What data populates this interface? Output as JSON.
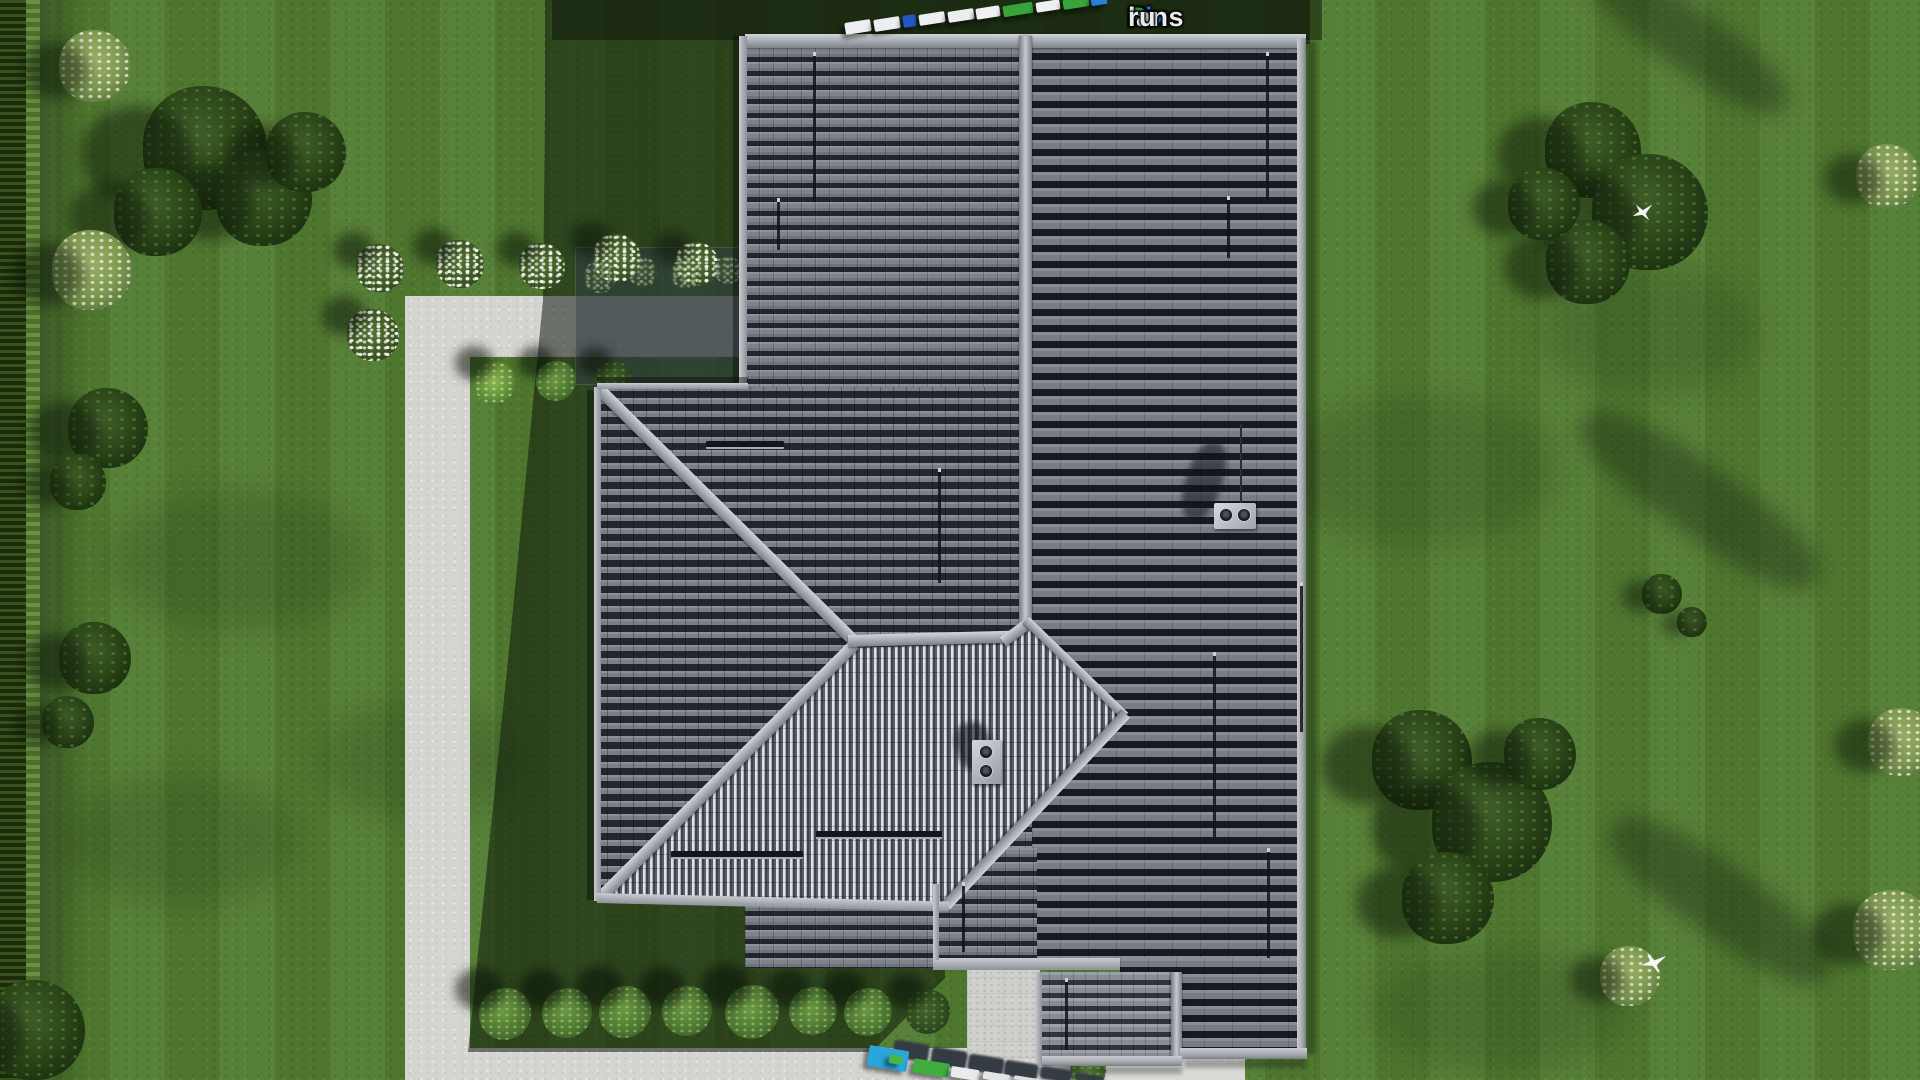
{
  "watermark": {
    "parts": [
      {
        "text": "Fix",
        "color": "#2e6ad4"
      },
      {
        "text": "P",
        "color": "#2f9e3c"
      },
      {
        "text": "lans",
        "color": "#e9ebee"
      },
      {
        "text": ".",
        "color": "#a81e1e"
      },
      {
        "text": "ru",
        "color": "#e9ebee"
      }
    ]
  },
  "palette": {
    "roof_dark": "#555a62",
    "roof_east_slope": "#7d828a",
    "roof_striped_light": "#dfe1e4",
    "roof_striped_dark": "#3e424a",
    "ridge_cap": "#c9ccd1",
    "fascia": "#b8bcc1",
    "walkway": "#d4d4d1",
    "patio": "#cfcfcb",
    "concrete_pad": "#dadad7",
    "grass": "#517b31",
    "grass_shadow": "#26401a",
    "hedge": "#24390f",
    "tree_dark": "#2c4719",
    "tree_light": "#8aa45c",
    "bush_green": "#55823a",
    "car_blue": "#2257c4",
    "car_cyan": "#2aa6db",
    "car_green": "#3fae3f",
    "car_white": "#eceef0"
  },
  "scene": {
    "grass_patches": [
      {
        "x": 240,
        "y": 560,
        "w": 260,
        "h": 140
      },
      {
        "x": 180,
        "y": 840,
        "w": 230,
        "h": 130
      },
      {
        "x": 420,
        "y": 760,
        "w": 200,
        "h": 120
      },
      {
        "x": 1420,
        "y": 470,
        "w": 280,
        "h": 150
      },
      {
        "x": 1650,
        "y": 330,
        "w": 220,
        "h": 130
      },
      {
        "x": 1500,
        "y": 1010,
        "w": 260,
        "h": 120
      }
    ],
    "shadow_streaks": [
      {
        "x": 1690,
        "y": 40,
        "w": 230,
        "h": 60,
        "rot": 35
      },
      {
        "x": 1700,
        "y": 500,
        "w": 280,
        "h": 70,
        "rot": 35
      },
      {
        "x": 1720,
        "y": 900,
        "w": 260,
        "h": 70,
        "rot": 35
      }
    ],
    "trees": [
      {
        "x": 205,
        "y": 148,
        "r": 62,
        "type": "dark"
      },
      {
        "x": 264,
        "y": 198,
        "r": 48,
        "type": "dark"
      },
      {
        "x": 158,
        "y": 212,
        "r": 44,
        "type": "dark"
      },
      {
        "x": 306,
        "y": 152,
        "r": 40,
        "type": "dark"
      },
      {
        "x": 95,
        "y": 66,
        "r": 36,
        "type": "light"
      },
      {
        "x": 92,
        "y": 270,
        "r": 40,
        "type": "light"
      },
      {
        "x": 108,
        "y": 428,
        "r": 40,
        "type": "dark"
      },
      {
        "x": 78,
        "y": 482,
        "r": 28,
        "type": "dark"
      },
      {
        "x": 95,
        "y": 658,
        "r": 36,
        "type": "dark"
      },
      {
        "x": 68,
        "y": 722,
        "r": 26,
        "type": "dark"
      },
      {
        "x": 35,
        "y": 1030,
        "r": 50,
        "type": "dark"
      },
      {
        "x": 1593,
        "y": 150,
        "r": 48,
        "type": "dark"
      },
      {
        "x": 1650,
        "y": 212,
        "r": 58,
        "type": "dark"
      },
      {
        "x": 1588,
        "y": 262,
        "r": 42,
        "type": "dark"
      },
      {
        "x": 1544,
        "y": 204,
        "r": 36,
        "type": "dark"
      },
      {
        "x": 1888,
        "y": 176,
        "r": 32,
        "type": "light"
      },
      {
        "x": 1902,
        "y": 742,
        "r": 34,
        "type": "light"
      },
      {
        "x": 1893,
        "y": 930,
        "r": 40,
        "type": "light"
      },
      {
        "x": 1422,
        "y": 760,
        "r": 50,
        "type": "dark"
      },
      {
        "x": 1492,
        "y": 822,
        "r": 60,
        "type": "dark"
      },
      {
        "x": 1448,
        "y": 898,
        "r": 46,
        "type": "dark"
      },
      {
        "x": 1540,
        "y": 754,
        "r": 36,
        "type": "dark"
      },
      {
        "x": 1630,
        "y": 976,
        "r": 30,
        "type": "light"
      },
      {
        "x": 1662,
        "y": 594,
        "r": 20,
        "type": "dark"
      },
      {
        "x": 1692,
        "y": 622,
        "r": 15,
        "type": "dark"
      }
    ],
    "flower_bushes": [
      {
        "x": 380,
        "y": 268,
        "r": 24
      },
      {
        "x": 460,
        "y": 264,
        "r": 24
      },
      {
        "x": 542,
        "y": 266,
        "r": 23
      },
      {
        "x": 617,
        "y": 258,
        "r": 24
      },
      {
        "x": 697,
        "y": 264,
        "r": 22
      },
      {
        "x": 373,
        "y": 335,
        "r": 26
      },
      {
        "x": 600,
        "y": 277,
        "r": 16,
        "dim": true
      },
      {
        "x": 643,
        "y": 272,
        "r": 15,
        "dim": true
      },
      {
        "x": 686,
        "y": 274,
        "r": 15,
        "dim": true
      },
      {
        "x": 728,
        "y": 270,
        "r": 14,
        "dim": true
      }
    ],
    "green_bushes": [
      {
        "x": 495,
        "y": 383,
        "r": 21,
        "shade": "bright"
      },
      {
        "x": 556,
        "y": 381,
        "r": 20,
        "shade": "mid"
      },
      {
        "x": 613,
        "y": 379,
        "r": 18,
        "shade": "dark"
      },
      {
        "x": 505,
        "y": 1014,
        "r": 26,
        "shade": "mid"
      },
      {
        "x": 567,
        "y": 1013,
        "r": 25,
        "shade": "mid"
      },
      {
        "x": 625,
        "y": 1012,
        "r": 26,
        "shade": "mid"
      },
      {
        "x": 687,
        "y": 1011,
        "r": 25,
        "shade": "mid"
      },
      {
        "x": 752,
        "y": 1012,
        "r": 27,
        "shade": "mid"
      },
      {
        "x": 813,
        "y": 1011,
        "r": 24,
        "shade": "mid"
      },
      {
        "x": 868,
        "y": 1012,
        "r": 24,
        "shade": "mid"
      },
      {
        "x": 928,
        "y": 1012,
        "r": 22,
        "shade": "dark"
      },
      {
        "x": 1088,
        "y": 1071,
        "r": 18,
        "shade": "mid"
      }
    ],
    "snow_guards": [
      {
        "x": 813,
        "y": 52,
        "h": 150
      },
      {
        "x": 777,
        "y": 198,
        "h": 52
      },
      {
        "x": 1266,
        "y": 52,
        "h": 148
      },
      {
        "x": 1227,
        "y": 196,
        "h": 62
      },
      {
        "x": 938,
        "y": 468,
        "h": 115
      },
      {
        "x": 1300,
        "y": 582,
        "h": 150
      },
      {
        "x": 1213,
        "y": 652,
        "h": 185
      },
      {
        "x": 1267,
        "y": 848,
        "h": 110
      },
      {
        "x": 962,
        "y": 882,
        "h": 70
      },
      {
        "x": 1065,
        "y": 978,
        "h": 72
      }
    ],
    "vents": [
      {
        "x": 706,
        "y": 441,
        "w": 78
      },
      {
        "x": 671,
        "y": 851,
        "w": 132
      },
      {
        "x": 816,
        "y": 831,
        "w": 126
      }
    ],
    "chimneys": [
      {
        "x": 1214,
        "y": 503,
        "pipes": 2
      },
      {
        "x": 972,
        "y": 740,
        "pipes": 2
      }
    ],
    "cars_top": [
      {
        "x": 845,
        "y": 21,
        "w": 26,
        "h": 12,
        "c": "#eceef0"
      },
      {
        "x": 874,
        "y": 18,
        "w": 26,
        "h": 12,
        "c": "#eceef0"
      },
      {
        "x": 903,
        "y": 15,
        "w": 13,
        "h": 12,
        "c": "#2257c4"
      },
      {
        "x": 919,
        "y": 13,
        "w": 26,
        "h": 11,
        "c": "#eceef0"
      },
      {
        "x": 948,
        "y": 10,
        "w": 26,
        "h": 11,
        "c": "#eceef0"
      },
      {
        "x": 976,
        "y": 7,
        "w": 24,
        "h": 11,
        "c": "#eef0f2"
      },
      {
        "x": 1003,
        "y": 4,
        "w": 30,
        "h": 11,
        "c": "#38a53c"
      },
      {
        "x": 1036,
        "y": 1,
        "w": 24,
        "h": 10,
        "c": "#eef0f2"
      },
      {
        "x": 1063,
        "y": -2,
        "w": 26,
        "h": 10,
        "c": "#38a53c"
      },
      {
        "x": 1091,
        "y": -4,
        "w": 16,
        "h": 9,
        "c": "#2c7fd6"
      }
    ],
    "cars_bottom_shadows": [
      {
        "x": 893,
        "y": 1042,
        "w": 36,
        "h": 18
      },
      {
        "x": 931,
        "y": 1049,
        "w": 36,
        "h": 18
      },
      {
        "x": 968,
        "y": 1056,
        "w": 36,
        "h": 17
      },
      {
        "x": 1004,
        "y": 1062,
        "w": 34,
        "h": 16
      },
      {
        "x": 1040,
        "y": 1068,
        "w": 32,
        "h": 13
      },
      {
        "x": 1074,
        "y": 1074,
        "w": 30,
        "h": 8
      }
    ],
    "cars_bottom": [
      {
        "x": 868,
        "y": 1048,
        "w": 40,
        "h": 21,
        "c": "#2aa6db"
      },
      {
        "x": 889,
        "y": 1055,
        "w": 13,
        "h": 9,
        "c": "#49b449"
      },
      {
        "x": 913,
        "y": 1061,
        "w": 36,
        "h": 14,
        "c": "#3fae3f"
      },
      {
        "x": 951,
        "y": 1068,
        "w": 28,
        "h": 11,
        "c": "#e8eaec"
      },
      {
        "x": 983,
        "y": 1073,
        "w": 27,
        "h": 8,
        "c": "#e2e4e7"
      },
      {
        "x": 1014,
        "y": 1077,
        "w": 24,
        "h": 4,
        "c": "#dde0e3"
      }
    ],
    "birds": [
      {
        "x": 1632,
        "y": 203,
        "s": 22,
        "rot": -15
      },
      {
        "x": 1641,
        "y": 952,
        "s": 26,
        "rot": -5
      }
    ]
  }
}
